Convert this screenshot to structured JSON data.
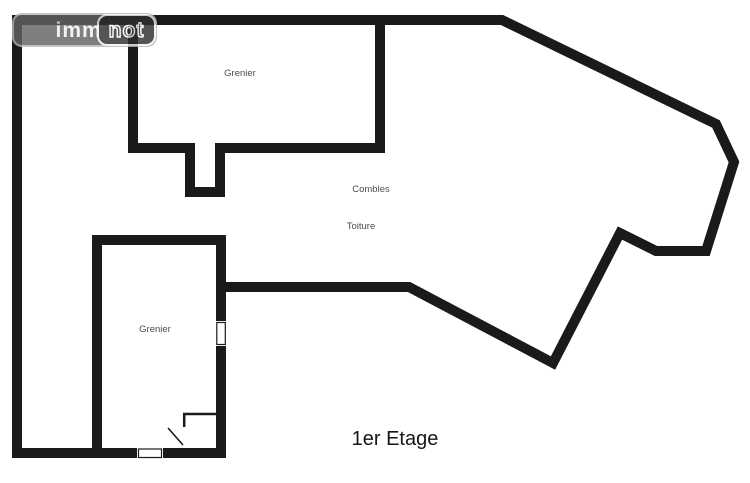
{
  "logo": {
    "left": "immo",
    "right": "not"
  },
  "plan": {
    "floor_label": "1er Etage",
    "rooms": [
      {
        "id": "grenier-upper",
        "label": "Grenier"
      },
      {
        "id": "combles",
        "label": "Combles"
      },
      {
        "id": "toiture",
        "label": "Toiture"
      },
      {
        "id": "grenier-lower",
        "label": "Grenier"
      }
    ]
  },
  "colors": {
    "wall": "#1a1a1a",
    "room_label": "#4d4d4d",
    "floor_label": "#161616",
    "background": "#ffffff",
    "logo_left_bg": "#636363",
    "logo_right_bg": "#2f2f2f",
    "logo_text": "#f0f0f0"
  }
}
